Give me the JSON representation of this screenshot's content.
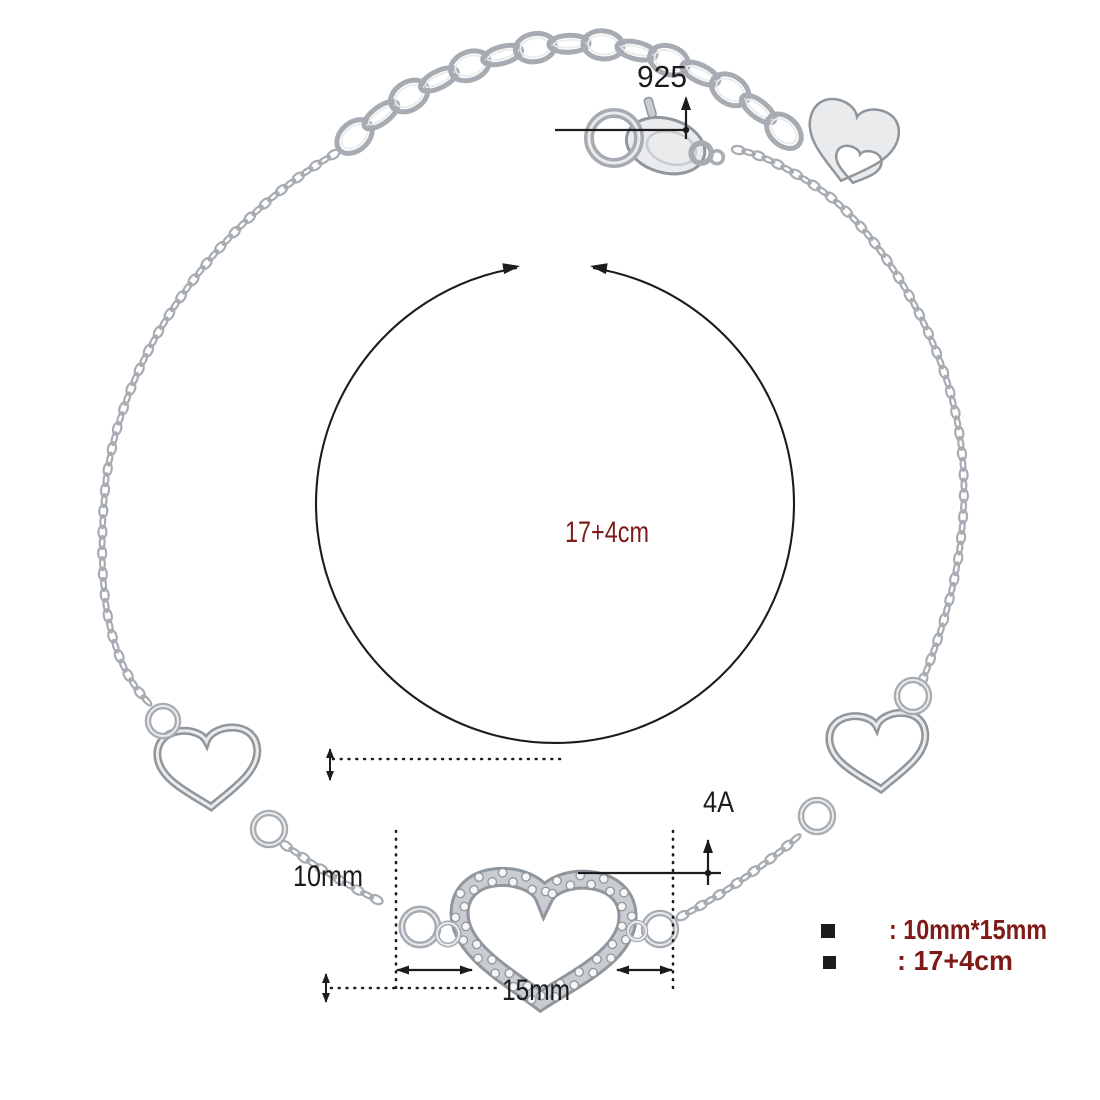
{
  "annotations": {
    "silver_stamp": "925",
    "chain_length": "17+4cm",
    "stone_grade": "4A",
    "pendant_height": "10mm",
    "pendant_width": "15mm"
  },
  "legend": {
    "items": [
      {
        "label": ": 10mm*15mm"
      },
      {
        "label": ": 17+4cm"
      }
    ]
  },
  "colors": {
    "background": "#ffffff",
    "annotation_ink": "#1c1c1c",
    "measure_red": "#7e1b18",
    "silver": "#a6acb2",
    "silver_dark": "#8f969c",
    "silver_mid": "#c9cdd1",
    "silver_light": "#e9ebed",
    "silver_highlight": "#f5f6f7"
  }
}
